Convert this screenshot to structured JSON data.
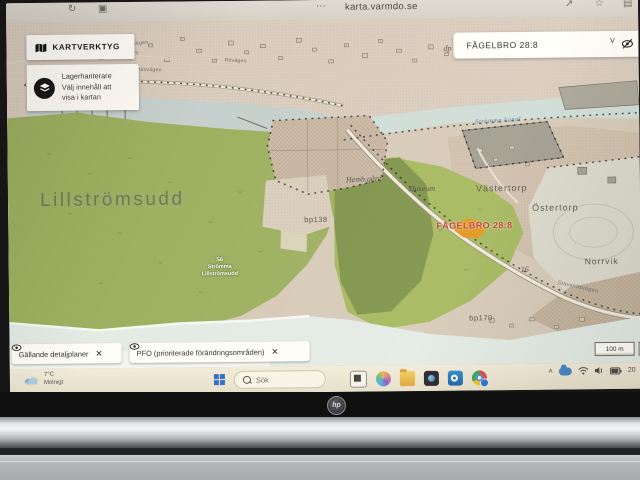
{
  "browser": {
    "url": "karta.varmdo.se"
  },
  "icons": {
    "reload": "↻",
    "tabs": "▣",
    "more": "⋯",
    "share": "↗",
    "star": "☆",
    "panel": "▤",
    "chevron_down": "˅",
    "chevron_up": "˄",
    "close": "✕"
  },
  "app": {
    "kartverktyg_label": "KARTVERKTYG",
    "layer_panel": {
      "title": "Lagerhanterare",
      "line1": "Välj innehåll att",
      "line2": "visa i kartan"
    },
    "search_value": "FÅGELBRO 28:8",
    "chips": [
      {
        "label": "Gällande detaljplaner"
      },
      {
        "label": "PFO (prioriterade förändringsområden)"
      }
    ],
    "scale_label": "100 m"
  },
  "map_labels": {
    "lillstromsudd": "Lillströmsudd",
    "s6_line1": "S6",
    "s6_line2": "Strömma",
    "s6_line3": "Lillströmsudd",
    "hembgard": "Hemb.gård",
    "museum": "Museum",
    "vastertorp": "Västertorp",
    "ostertorp": "Östertorp",
    "norrvik": "Norrvik",
    "stromma_kanal": "Strömma kanal",
    "larkvagen": "Lärkvägen",
    "rovagen": "Rövägen",
    "algsnasvagen": "Älgsnäsvägen",
    "stavsnasvagen": "Stavsnäsvägen",
    "bp138": "bp138",
    "bp170": "bp170",
    "parcel16": "16",
    "dp": "dp",
    "selected_property": "FÅGELBRO 28:8"
  },
  "map_colors": {
    "land": "#d5c8b7",
    "forest": "#9bb15a",
    "forest_bright": "#a2b957",
    "forest_dark": "#7d9546",
    "water": "#cbdbd8",
    "water_south": "#dfe9e5",
    "selected_fill": "#e8940e",
    "selected_text": "#bf3a2b"
  },
  "taskbar": {
    "temp": "7°C",
    "condition": "Molnigt",
    "search": "Sök",
    "clock": "20"
  },
  "laptop": {
    "brand": "hp"
  }
}
